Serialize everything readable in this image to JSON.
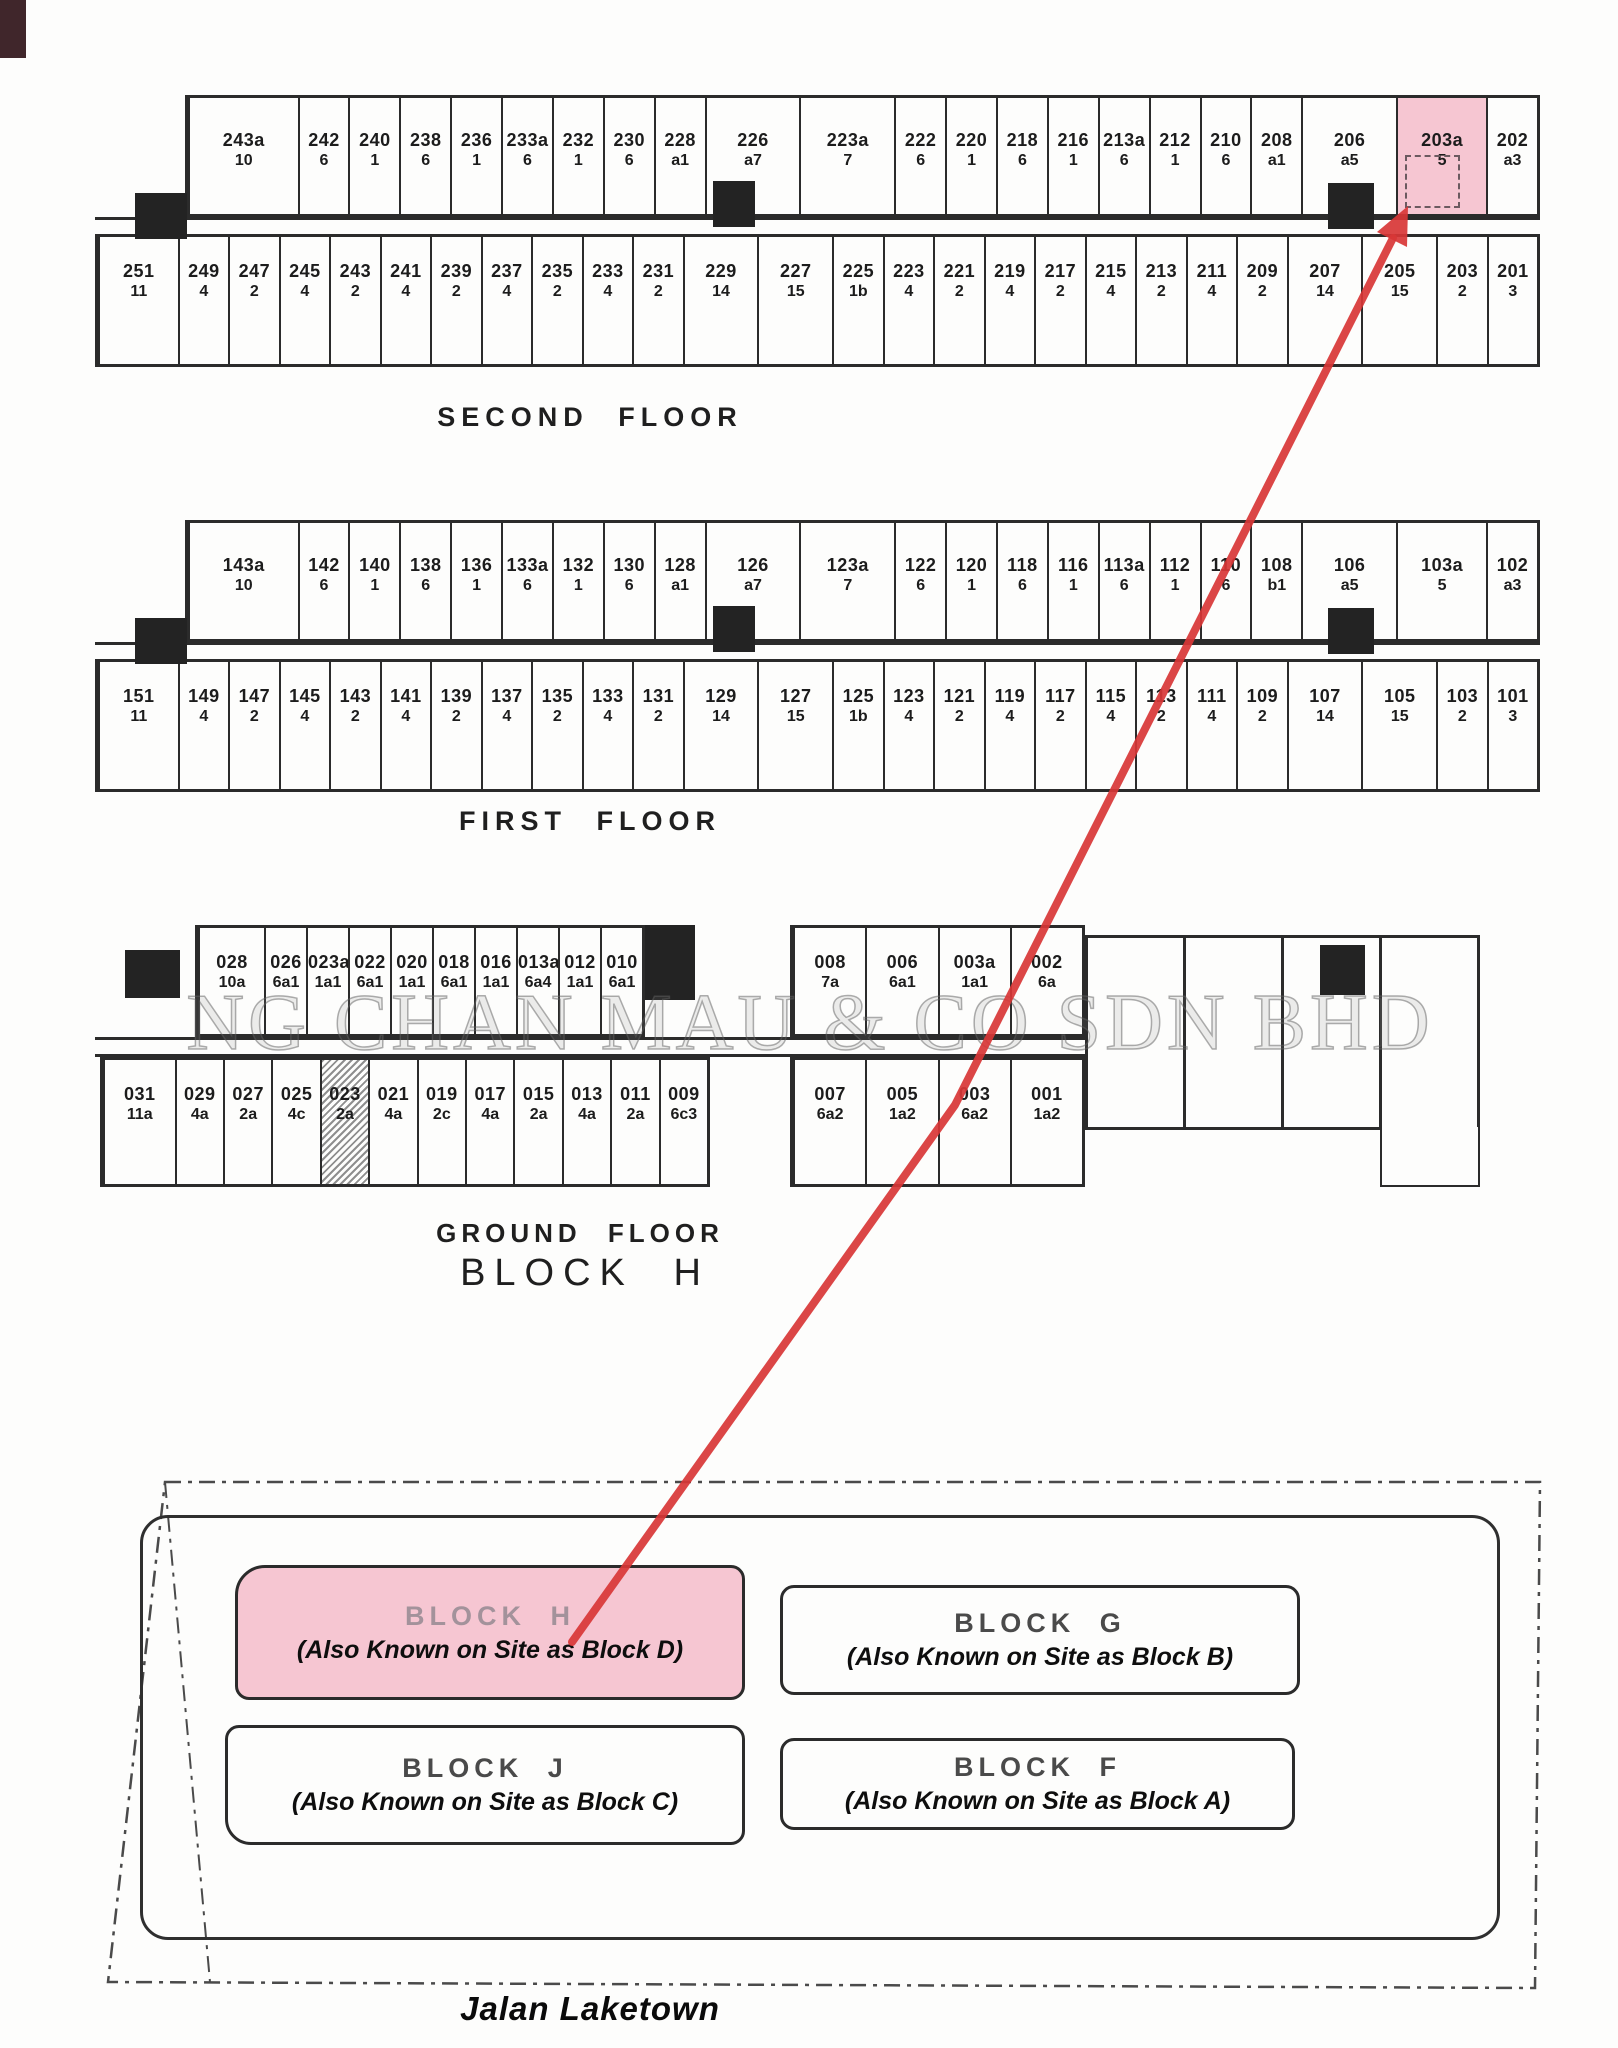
{
  "floors": [
    {
      "label": "SECOND FLOOR",
      "top": [
        {
          "no": "243a",
          "t": "10",
          "w": 2.2
        },
        {
          "no": "242",
          "t": "6"
        },
        {
          "no": "240",
          "t": "1"
        },
        {
          "no": "238",
          "t": "6"
        },
        {
          "no": "236",
          "t": "1"
        },
        {
          "no": "233a",
          "t": "6"
        },
        {
          "no": "232",
          "t": "1"
        },
        {
          "no": "230",
          "t": "6"
        },
        {
          "no": "228",
          "t": "a1"
        },
        {
          "no": "226",
          "t": "a7",
          "w": 1.9
        },
        {
          "no": "223a",
          "t": "7",
          "w": 1.9
        },
        {
          "no": "222",
          "t": "6"
        },
        {
          "no": "220",
          "t": "1"
        },
        {
          "no": "218",
          "t": "6"
        },
        {
          "no": "216",
          "t": "1"
        },
        {
          "no": "213a",
          "t": "6"
        },
        {
          "no": "212",
          "t": "1"
        },
        {
          "no": "210",
          "t": "6"
        },
        {
          "no": "208",
          "t": "a1"
        },
        {
          "no": "206",
          "t": "a5",
          "w": 1.9
        },
        {
          "no": "203a",
          "t": "5",
          "w": 1.8,
          "hl": true
        },
        {
          "no": "202",
          "t": "a3"
        }
      ],
      "bottom": [
        {
          "no": "251",
          "t": "11",
          "w": 1.6
        },
        {
          "no": "249",
          "t": "4"
        },
        {
          "no": "247",
          "t": "2"
        },
        {
          "no": "245",
          "t": "4"
        },
        {
          "no": "243",
          "t": "2"
        },
        {
          "no": "241",
          "t": "4"
        },
        {
          "no": "239",
          "t": "2"
        },
        {
          "no": "237",
          "t": "4"
        },
        {
          "no": "235",
          "t": "2"
        },
        {
          "no": "233",
          "t": "4"
        },
        {
          "no": "231",
          "t": "2"
        },
        {
          "no": "229",
          "t": "14",
          "w": 1.5
        },
        {
          "no": "227",
          "t": "15",
          "w": 1.5
        },
        {
          "no": "225",
          "t": "1b"
        },
        {
          "no": "223",
          "t": "4"
        },
        {
          "no": "221",
          "t": "2"
        },
        {
          "no": "219",
          "t": "4"
        },
        {
          "no": "217",
          "t": "2"
        },
        {
          "no": "215",
          "t": "4"
        },
        {
          "no": "213",
          "t": "2"
        },
        {
          "no": "211",
          "t": "4"
        },
        {
          "no": "209",
          "t": "2"
        },
        {
          "no": "207",
          "t": "14",
          "w": 1.5
        },
        {
          "no": "205",
          "t": "15",
          "w": 1.5
        },
        {
          "no": "203",
          "t": "2"
        },
        {
          "no": "201",
          "t": "3"
        }
      ]
    },
    {
      "label": "FIRST FLOOR",
      "top": [
        {
          "no": "143a",
          "t": "10",
          "w": 2.2
        },
        {
          "no": "142",
          "t": "6"
        },
        {
          "no": "140",
          "t": "1"
        },
        {
          "no": "138",
          "t": "6"
        },
        {
          "no": "136",
          "t": "1"
        },
        {
          "no": "133a",
          "t": "6"
        },
        {
          "no": "132",
          "t": "1"
        },
        {
          "no": "130",
          "t": "6"
        },
        {
          "no": "128",
          "t": "a1"
        },
        {
          "no": "126",
          "t": "a7",
          "w": 1.9
        },
        {
          "no": "123a",
          "t": "7",
          "w": 1.9
        },
        {
          "no": "122",
          "t": "6"
        },
        {
          "no": "120",
          "t": "1"
        },
        {
          "no": "118",
          "t": "6"
        },
        {
          "no": "116",
          "t": "1"
        },
        {
          "no": "113a",
          "t": "6"
        },
        {
          "no": "112",
          "t": "1"
        },
        {
          "no": "110",
          "t": "6"
        },
        {
          "no": "108",
          "t": "b1"
        },
        {
          "no": "106",
          "t": "a5",
          "w": 1.9
        },
        {
          "no": "103a",
          "t": "5",
          "w": 1.8
        },
        {
          "no": "102",
          "t": "a3"
        }
      ],
      "bottom": [
        {
          "no": "151",
          "t": "11",
          "w": 1.6
        },
        {
          "no": "149",
          "t": "4"
        },
        {
          "no": "147",
          "t": "2"
        },
        {
          "no": "145",
          "t": "4"
        },
        {
          "no": "143",
          "t": "2"
        },
        {
          "no": "141",
          "t": "4"
        },
        {
          "no": "139",
          "t": "2"
        },
        {
          "no": "137",
          "t": "4"
        },
        {
          "no": "135",
          "t": "2"
        },
        {
          "no": "133",
          "t": "4"
        },
        {
          "no": "131",
          "t": "2"
        },
        {
          "no": "129",
          "t": "14",
          "w": 1.5
        },
        {
          "no": "127",
          "t": "15",
          "w": 1.5
        },
        {
          "no": "125",
          "t": "1b"
        },
        {
          "no": "123",
          "t": "4"
        },
        {
          "no": "121",
          "t": "2"
        },
        {
          "no": "119",
          "t": "4"
        },
        {
          "no": "117",
          "t": "2"
        },
        {
          "no": "115",
          "t": "4"
        },
        {
          "no": "113",
          "t": "2"
        },
        {
          "no": "111",
          "t": "4"
        },
        {
          "no": "109",
          "t": "2"
        },
        {
          "no": "107",
          "t": "14",
          "w": 1.5
        },
        {
          "no": "105",
          "t": "15",
          "w": 1.5
        },
        {
          "no": "103",
          "t": "2"
        },
        {
          "no": "101",
          "t": "3"
        }
      ]
    }
  ],
  "ground": {
    "label": "GROUND FLOOR",
    "block_label": "BLOCK H",
    "top_left": [
      {
        "no": "028",
        "t": "10a",
        "w": 1.6
      },
      {
        "no": "026",
        "t": "6a1"
      },
      {
        "no": "023a",
        "t": "1a1"
      },
      {
        "no": "022",
        "t": "6a1"
      },
      {
        "no": "020",
        "t": "1a1"
      },
      {
        "no": "018",
        "t": "6a1"
      },
      {
        "no": "016",
        "t": "1a1"
      },
      {
        "no": "013a",
        "t": "6a4"
      },
      {
        "no": "012",
        "t": "1a1"
      },
      {
        "no": "010",
        "t": "6a1"
      }
    ],
    "top_right": [
      {
        "no": "008",
        "t": "7a"
      },
      {
        "no": "006",
        "t": "6a1"
      },
      {
        "no": "003a",
        "t": "1a1"
      },
      {
        "no": "002",
        "t": "6a"
      }
    ],
    "bottom_left": [
      {
        "no": "031",
        "t": "11a",
        "w": 1.5
      },
      {
        "no": "029",
        "t": "4a"
      },
      {
        "no": "027",
        "t": "2a"
      },
      {
        "no": "025",
        "t": "4c"
      },
      {
        "no": "023",
        "t": "2a",
        "hatch": true
      },
      {
        "no": "021",
        "t": "4a"
      },
      {
        "no": "019",
        "t": "2c"
      },
      {
        "no": "017",
        "t": "4a"
      },
      {
        "no": "015",
        "t": "2a"
      },
      {
        "no": "013",
        "t": "4a"
      },
      {
        "no": "011",
        "t": "2a"
      },
      {
        "no": "009",
        "t": "6c3"
      }
    ],
    "bottom_right": [
      {
        "no": "007",
        "t": "6a2"
      },
      {
        "no": "005",
        "t": "1a2"
      },
      {
        "no": "003",
        "t": "6a2"
      },
      {
        "no": "001",
        "t": "1a2"
      }
    ]
  },
  "site": {
    "blocks": [
      {
        "name": "BLOCK H",
        "aka": "(Also Known on Site as Block D)",
        "hl": true
      },
      {
        "name": "BLOCK G",
        "aka": "(Also Known on Site as Block B)"
      },
      {
        "name": "BLOCK J",
        "aka": "(Also Known on Site as Block C)"
      },
      {
        "name": "BLOCK F",
        "aka": "(Also Known on Site as Block A)"
      }
    ],
    "street": "Jalan Laketown"
  },
  "watermark": "NG CHAN MAU & CO SDN BHD",
  "highlighted_unit": "203a",
  "colors": {
    "highlight_pink": "#f6c6d2",
    "arrow_red": "#d83636",
    "line": "#2b2b2b"
  }
}
